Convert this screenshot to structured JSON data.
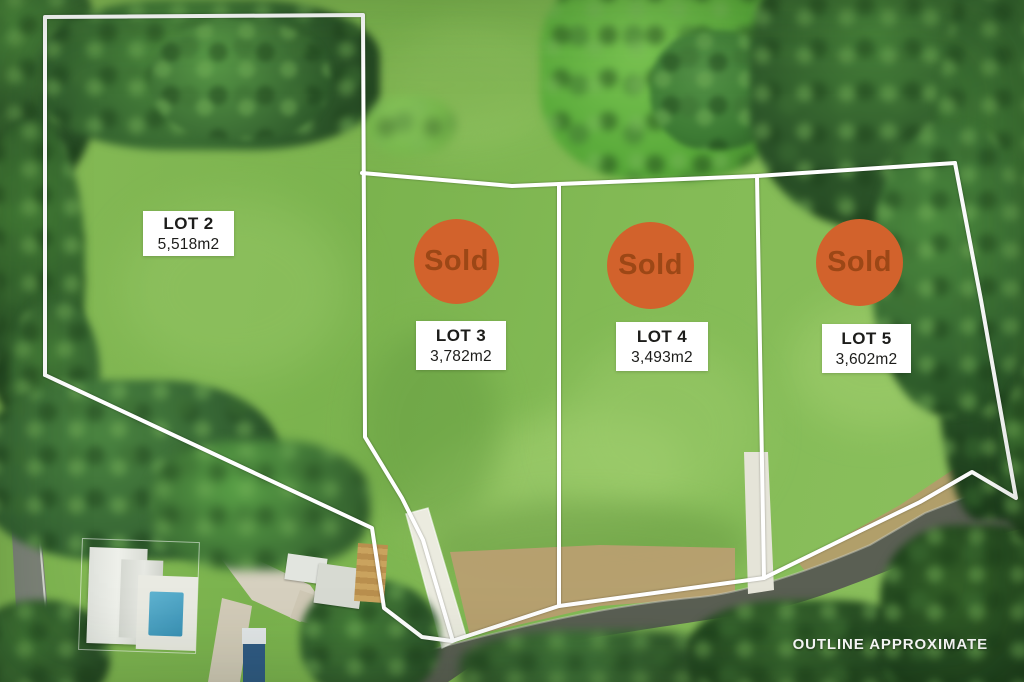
{
  "image_type": "aerial-lot-subdivision-plan",
  "watermark": "OUTLINE APPROXIMATE",
  "sold_label": "Sold",
  "lots": [
    {
      "id": "lot-2",
      "name": "LOT 2",
      "area": "5,518m2",
      "status": "available"
    },
    {
      "id": "lot-3",
      "name": "LOT 3",
      "area": "3,782m2",
      "status": "sold"
    },
    {
      "id": "lot-4",
      "name": "LOT 4",
      "area": "3,493m2",
      "status": "sold"
    },
    {
      "id": "lot-5",
      "name": "LOT 5",
      "area": "3,602m2",
      "status": "sold"
    }
  ],
  "colors": {
    "boundary_line": "#ffffff",
    "sold_badge": "#d2622c",
    "sold_text": "#9c4716",
    "label_box": "#ffffff",
    "label_text": "#1d1d1b",
    "grass": "#80b651",
    "forest": "#2f5a2b",
    "road": "#5a5f53"
  }
}
